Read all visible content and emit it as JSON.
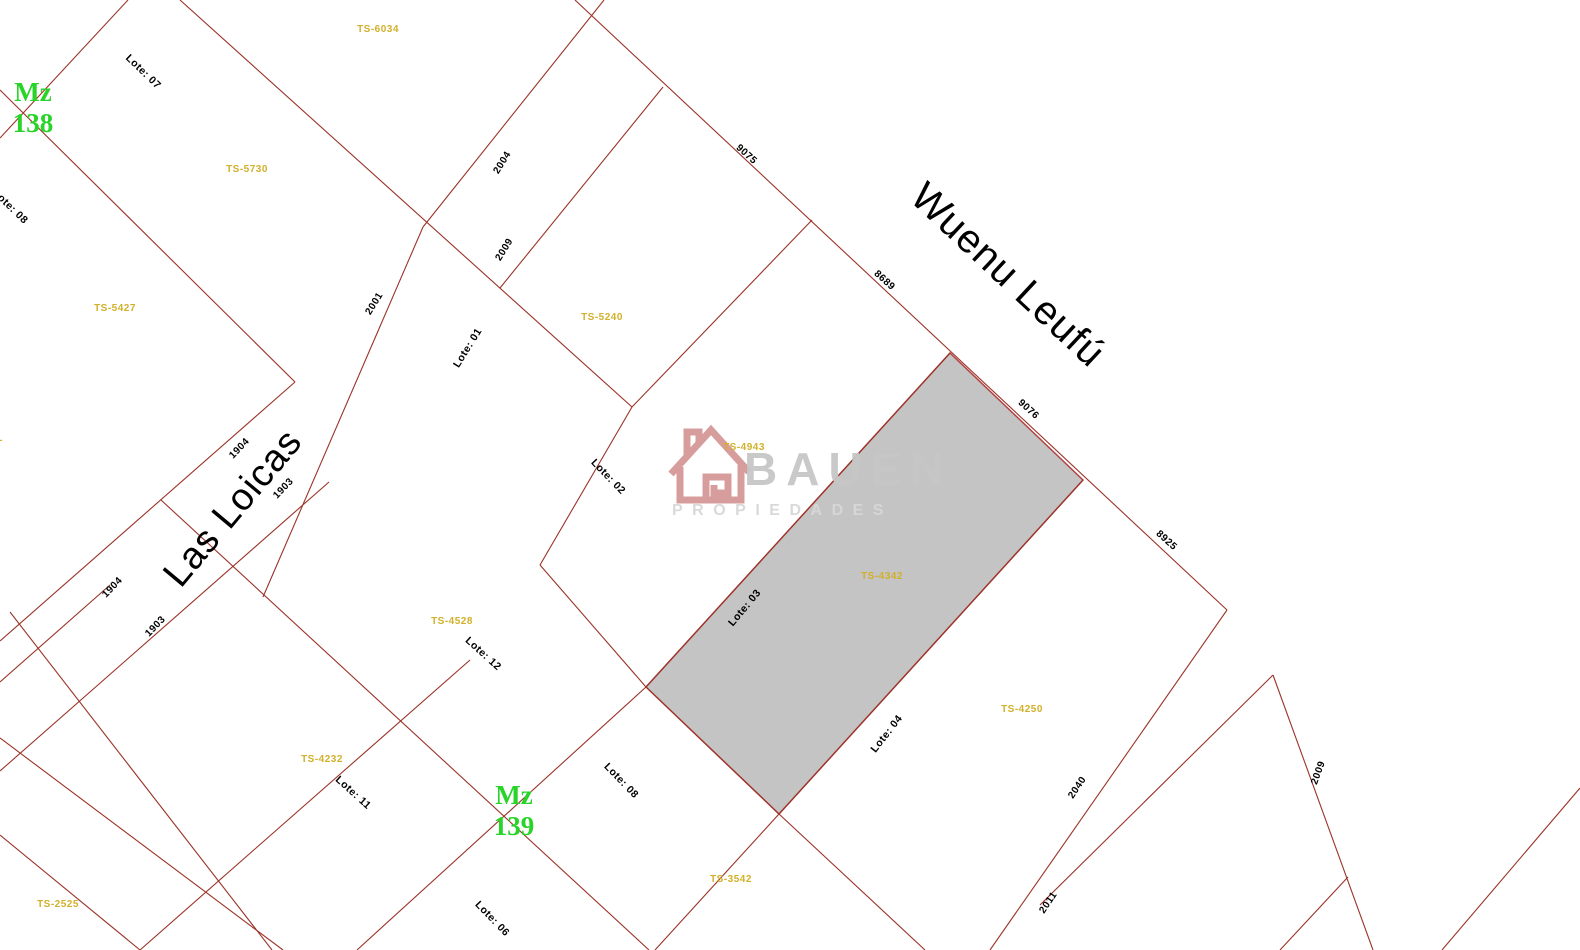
{
  "watermark": {
    "brand": "BAUEN",
    "subtitle": "PROPIEDADES",
    "brand_color": "#c7c7c7",
    "subtitle_color": "#d8d8d8",
    "house_color": "#d28f8f"
  },
  "map": {
    "width": 1580,
    "height": 950,
    "background": "#ffffff",
    "line_color": "#9a3328",
    "colors": {
      "lot": "#000000",
      "ts": "#d2b02a",
      "number": "#000000",
      "block": "#28d428"
    },
    "highlight": {
      "fill": "#c4c4c4",
      "stroke": "#b04040",
      "points": [
        [
          950,
          353
        ],
        [
          1083,
          480
        ],
        [
          779,
          814
        ],
        [
          646,
          687
        ]
      ]
    },
    "segments": [
      [
        128,
        0,
        0,
        138
      ],
      [
        0,
        90,
        295,
        382
      ],
      [
        295,
        382,
        0,
        641
      ],
      [
        329,
        482,
        0,
        771
      ],
      [
        161,
        500,
        649,
        950
      ],
      [
        180,
        0,
        632,
        407
      ],
      [
        604,
        0,
        423,
        227
      ],
      [
        423,
        227,
        263,
        597
      ],
      [
        646,
        687,
        357,
        950
      ],
      [
        646,
        687,
        950,
        353
      ],
      [
        1083,
        480,
        779,
        814
      ],
      [
        779,
        814,
        646,
        687
      ],
      [
        575,
        0,
        1227,
        610
      ],
      [
        663,
        87,
        500,
        288
      ],
      [
        812,
        220,
        632,
        407
      ],
      [
        632,
        407,
        540,
        565
      ],
      [
        540,
        565,
        646,
        687
      ],
      [
        779,
        814,
        655,
        950
      ],
      [
        779,
        814,
        925,
        950
      ],
      [
        1227,
        610,
        990,
        950
      ],
      [
        1273,
        675,
        1040,
        905
      ],
      [
        1273,
        675,
        1373,
        950
      ],
      [
        1348,
        877,
        1280,
        950
      ],
      [
        1442,
        950,
        1580,
        788
      ],
      [
        110,
        585,
        0,
        682
      ],
      [
        10,
        612,
        272,
        950
      ],
      [
        0,
        738,
        283,
        950
      ],
      [
        0,
        835,
        140,
        950
      ],
      [
        140,
        950,
        470,
        660
      ]
    ],
    "block_labels": [
      {
        "prefix": "Mz",
        "number": "138",
        "x": 33,
        "y": 108
      },
      {
        "prefix": "Mz",
        "number": "139",
        "x": 514,
        "y": 811
      }
    ],
    "street_names": [
      {
        "text": "Las Loicas",
        "x": 233,
        "y": 508,
        "rotation": -50,
        "size": 38
      },
      {
        "text": "Wuenu Leufú",
        "x": 1008,
        "y": 275,
        "rotation": 43,
        "size": 40
      }
    ],
    "lot_labels": [
      {
        "text": "Lote: 07",
        "x": 143,
        "y": 72,
        "rotation": 44
      },
      {
        "text": "Lote: 08",
        "x": 10,
        "y": 207,
        "rotation": 44
      },
      {
        "text": "Lote: 01",
        "x": 468,
        "y": 348,
        "rotation": -58
      },
      {
        "text": "Lote: 02",
        "x": 608,
        "y": 477,
        "rotation": 46
      },
      {
        "text": "Lote: 03",
        "x": 745,
        "y": 608,
        "rotation": -50
      },
      {
        "text": "Lote: 12",
        "x": 483,
        "y": 654,
        "rotation": 42
      },
      {
        "text": "Lote: 11",
        "x": 353,
        "y": 793,
        "rotation": 42
      },
      {
        "text": "Lote: 08",
        "x": 621,
        "y": 781,
        "rotation": 46
      },
      {
        "text": "Lote: 06",
        "x": 492,
        "y": 919,
        "rotation": 46
      },
      {
        "text": "Lote: 04",
        "x": 887,
        "y": 734,
        "rotation": -52
      }
    ],
    "ts_labels": [
      {
        "text": "TS-6034",
        "x": 378,
        "y": 30
      },
      {
        "text": "TS-5730",
        "x": 247,
        "y": 170
      },
      {
        "text": "TS-5427",
        "x": 115,
        "y": 309
      },
      {
        "text": "TS-",
        "x": -6,
        "y": 441
      },
      {
        "text": "TS-5240",
        "x": 602,
        "y": 318
      },
      {
        "text": "TS-4943",
        "x": 744,
        "y": 448
      },
      {
        "text": "TS-4342",
        "x": 882,
        "y": 577
      },
      {
        "text": "TS-4528",
        "x": 452,
        "y": 622
      },
      {
        "text": "TS-4232",
        "x": 322,
        "y": 760
      },
      {
        "text": "TS-2525",
        "x": 58,
        "y": 905
      },
      {
        "text": "TS-3542",
        "x": 731,
        "y": 880
      },
      {
        "text": "TS-4250",
        "x": 1022,
        "y": 710
      }
    ],
    "street_numbers": [
      {
        "text": "2004",
        "x": 503,
        "y": 163,
        "rotation": -58
      },
      {
        "text": "2009",
        "x": 505,
        "y": 250,
        "rotation": -58
      },
      {
        "text": "2001",
        "x": 375,
        "y": 304,
        "rotation": -58
      },
      {
        "text": "1904",
        "x": 240,
        "y": 449,
        "rotation": -46
      },
      {
        "text": "1903",
        "x": 284,
        "y": 489,
        "rotation": -46
      },
      {
        "text": "1904",
        "x": 113,
        "y": 588,
        "rotation": -46
      },
      {
        "text": "1903",
        "x": 156,
        "y": 627,
        "rotation": -46
      },
      {
        "text": "9075",
        "x": 746,
        "y": 155,
        "rotation": 42
      },
      {
        "text": "8689",
        "x": 884,
        "y": 281,
        "rotation": 42
      },
      {
        "text": "9076",
        "x": 1028,
        "y": 410,
        "rotation": 42
      },
      {
        "text": "8925",
        "x": 1166,
        "y": 541,
        "rotation": 42
      },
      {
        "text": "2040",
        "x": 1078,
        "y": 788,
        "rotation": -56
      },
      {
        "text": "2011",
        "x": 1049,
        "y": 903,
        "rotation": -56
      },
      {
        "text": "2009",
        "x": 1319,
        "y": 773,
        "rotation": -70
      }
    ]
  }
}
